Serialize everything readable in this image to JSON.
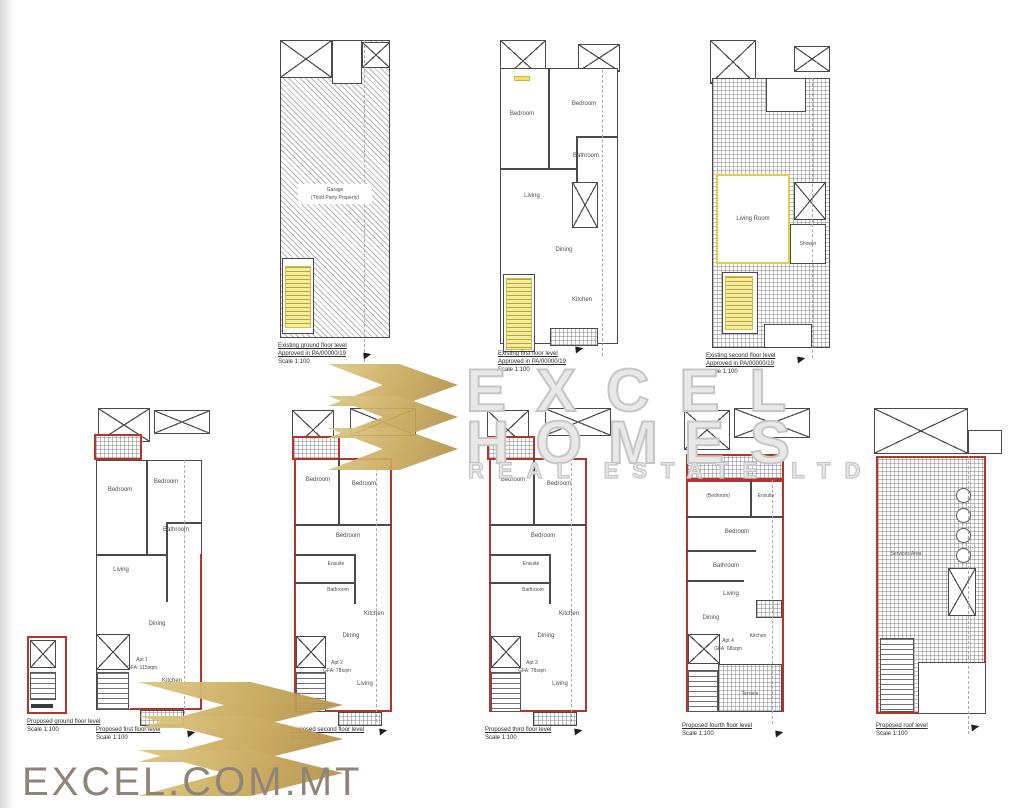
{
  "branding": {
    "watermark": {
      "line1": "EXCEL",
      "line2": "HOMES",
      "line3": "REAL ESTATE LTD"
    },
    "footer_text": "EXCEL.COM.MT",
    "gold_color": "#c9a95c",
    "red_color": "#b5352d",
    "yellow_color": "#f6ee9b"
  },
  "plans": {
    "existing_ground": {
      "caption": [
        "Existing ground floor level",
        "Approved in PA/00000/19",
        "Scale 1:100"
      ],
      "rooms": [
        "Garage",
        "(Third Party Property)"
      ]
    },
    "existing_first": {
      "caption": [
        "Existing first floor level",
        "Approved in PA/00000/19",
        "Scale 1:100"
      ],
      "rooms": [
        "Bedroom",
        "Bedroom",
        "Bathroom",
        "Living",
        "Dining",
        "Kitchen"
      ]
    },
    "existing_second": {
      "caption": [
        "Existing second floor level",
        "Approved in PA/00000/19",
        "Scale 1:100"
      ],
      "rooms": [
        "Living Room",
        "Shower"
      ]
    },
    "proposed_ground": {
      "caption": [
        "Proposed ground floor level",
        "Scale 1:100"
      ],
      "rooms": []
    },
    "proposed_first": {
      "caption": [
        "Proposed first floor level",
        "Scale 1:100"
      ],
      "apt": "Apt 1",
      "gfa": "GFA: 115sqm",
      "rooms": [
        "Bedroom",
        "Bedroom",
        "Bathroom",
        "Living",
        "Dining",
        "Kitchen"
      ]
    },
    "proposed_second": {
      "caption": [
        "Proposed second floor level",
        "Scale 1:100"
      ],
      "apt": "Apt 2",
      "gfa": "GFA: 78sqm",
      "rooms": [
        "Bedroom",
        "Bedroom",
        "Bedroom",
        "Ensuite",
        "Bathroom",
        "Kitchen",
        "Dining",
        "Living"
      ]
    },
    "proposed_third": {
      "caption": [
        "Proposed third floor level",
        "Scale 1:100"
      ],
      "apt": "Apt 3",
      "gfa": "GFA: 78sqm",
      "rooms": [
        "Bedroom",
        "Bedroom",
        "Bedroom",
        "Ensuite",
        "Bathroom",
        "Kitchen",
        "Dining",
        "Living"
      ]
    },
    "proposed_fourth": {
      "caption": [
        "Proposed fourth floor level",
        "Scale 1:100"
      ],
      "apt": "Apt 4",
      "gfa": "GFA: 68sqm",
      "rooms": [
        "(Bedroom)",
        "Ensuite",
        "Bedroom",
        "Bathroom",
        "Living",
        "Dining",
        "Kitchen",
        "Terrace"
      ]
    },
    "proposed_roof": {
      "caption": [
        "Proposed roof level",
        "Scale 1:100"
      ],
      "rooms": [
        "Services Area"
      ]
    }
  }
}
